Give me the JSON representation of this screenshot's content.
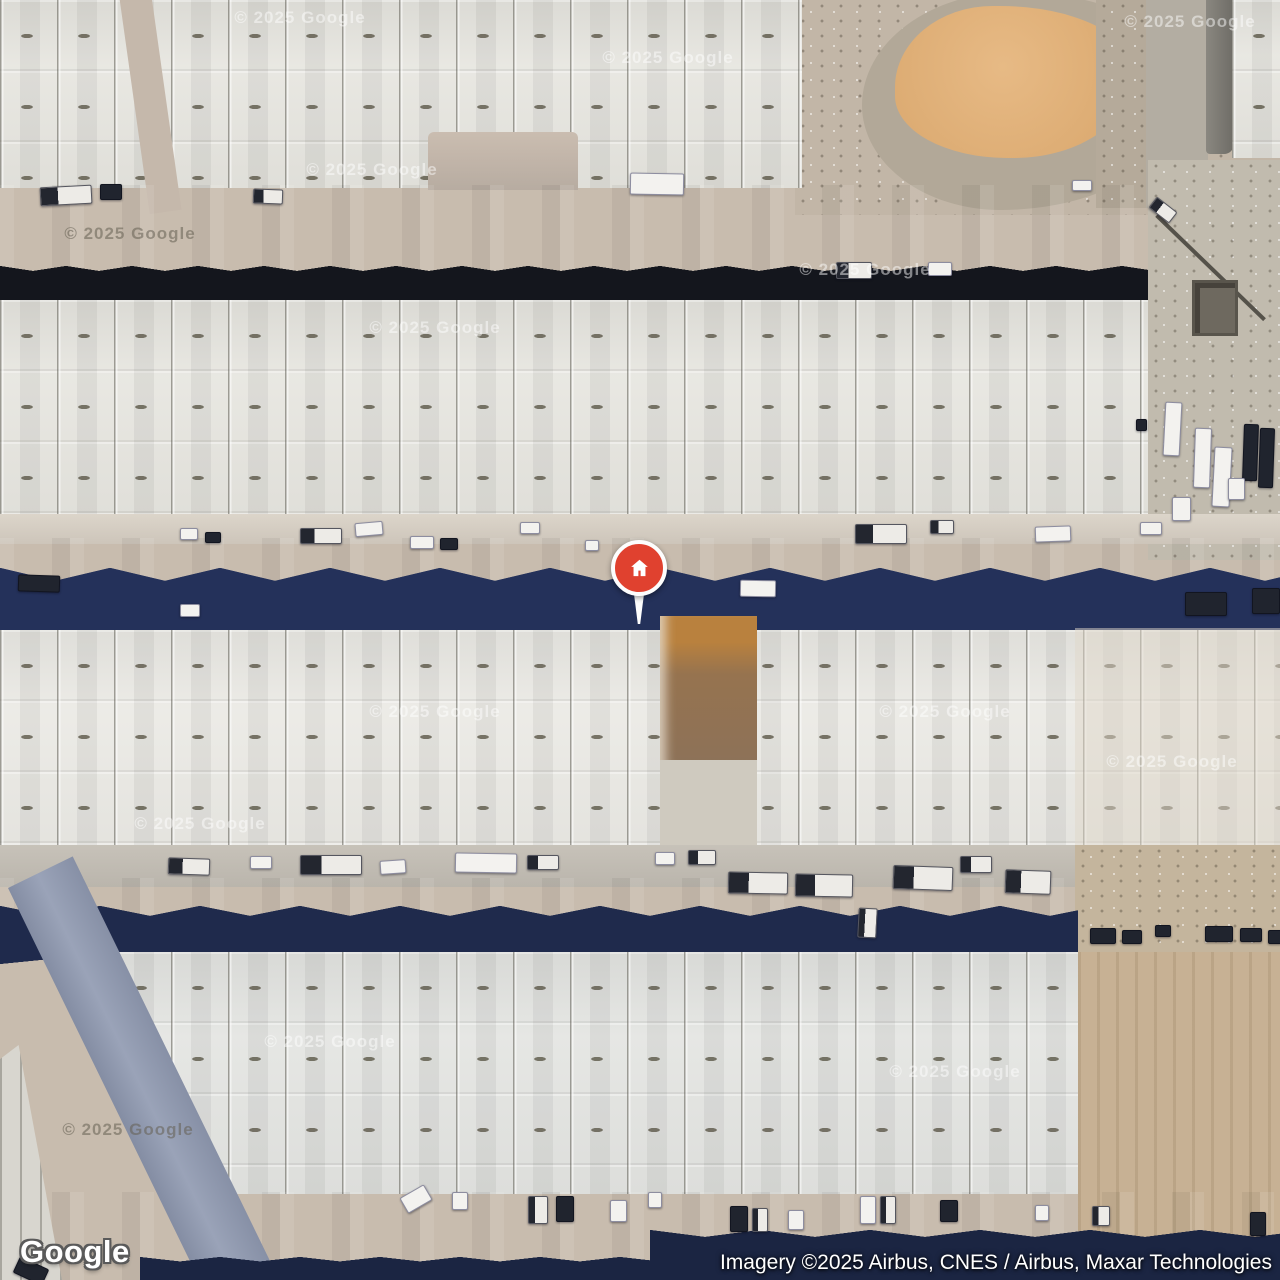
{
  "map": {
    "logo": "Google",
    "attribution": "Imagery ©2025 Airbus, CNES / Airbus, Maxar Technologies",
    "watermark_text": "© 2025 Google",
    "marker": {
      "x": 639,
      "y": 624,
      "icon": "home-icon",
      "color": "#E0412F"
    },
    "colors": {
      "marker_red": "#E0412F",
      "shadow_navy": "#24315A",
      "shadow_black": "#14161D",
      "roof_light": "#E7E6E0",
      "road_blue": "#99A3B8",
      "road_tan": "#C6B9AD",
      "sand": "#DCAB72"
    },
    "watermarks": [
      [
        300,
        18,
        "light"
      ],
      [
        668,
        58,
        "light"
      ],
      [
        1190,
        22,
        "light"
      ],
      [
        372,
        170,
        "light"
      ],
      [
        130,
        234,
        "dark"
      ],
      [
        435,
        328,
        "light"
      ],
      [
        865,
        270,
        "light"
      ],
      [
        435,
        712,
        "light"
      ],
      [
        945,
        712,
        "light"
      ],
      [
        1172,
        762,
        "light"
      ],
      [
        200,
        824,
        "light"
      ],
      [
        330,
        1042,
        "light"
      ],
      [
        955,
        1072,
        "light"
      ],
      [
        128,
        1130,
        "dark"
      ]
    ],
    "vehicles": [
      [
        40,
        186,
        50,
        17,
        -3,
        "m"
      ],
      [
        100,
        184,
        20,
        14,
        0,
        "d"
      ],
      [
        253,
        189,
        28,
        13,
        2,
        "m"
      ],
      [
        630,
        173,
        52,
        20,
        1,
        "w"
      ],
      [
        836,
        262,
        34,
        15,
        0,
        "m"
      ],
      [
        928,
        262,
        22,
        12,
        0,
        "w"
      ],
      [
        1072,
        180,
        18,
        9,
        0,
        "w"
      ],
      [
        1150,
        203,
        24,
        12,
        38,
        "m"
      ],
      [
        1164,
        402,
        15,
        52,
        3,
        "w"
      ],
      [
        1194,
        428,
        15,
        58,
        2,
        "w"
      ],
      [
        1213,
        447,
        16,
        58,
        3,
        "w"
      ],
      [
        1243,
        424,
        13,
        55,
        2,
        "d"
      ],
      [
        1259,
        428,
        13,
        58,
        2,
        "d"
      ],
      [
        1172,
        497,
        17,
        22,
        0,
        "w"
      ],
      [
        1228,
        478,
        15,
        20,
        0,
        "w"
      ],
      [
        1136,
        419,
        9,
        10,
        0,
        "d"
      ],
      [
        180,
        528,
        16,
        10,
        0,
        "w"
      ],
      [
        205,
        532,
        14,
        9,
        0,
        "d"
      ],
      [
        300,
        528,
        40,
        14,
        0,
        "m"
      ],
      [
        355,
        522,
        26,
        12,
        -5,
        "w"
      ],
      [
        410,
        536,
        22,
        11,
        0,
        "w"
      ],
      [
        440,
        538,
        16,
        10,
        0,
        "d"
      ],
      [
        520,
        522,
        18,
        10,
        0,
        "w"
      ],
      [
        585,
        540,
        12,
        9,
        0,
        "w"
      ],
      [
        18,
        575,
        40,
        15,
        2,
        "d"
      ],
      [
        180,
        604,
        18,
        11,
        0,
        "w"
      ],
      [
        740,
        580,
        34,
        15,
        1,
        "w"
      ],
      [
        855,
        524,
        50,
        18,
        0,
        "m"
      ],
      [
        930,
        520,
        22,
        12,
        0,
        "m"
      ],
      [
        1035,
        526,
        34,
        14,
        -2,
        "w"
      ],
      [
        1140,
        522,
        20,
        11,
        0,
        "w"
      ],
      [
        1185,
        592,
        40,
        22,
        0,
        "d"
      ],
      [
        1252,
        588,
        26,
        24,
        0,
        "d"
      ],
      [
        168,
        858,
        40,
        15,
        2,
        "m"
      ],
      [
        250,
        856,
        20,
        11,
        0,
        "w"
      ],
      [
        300,
        855,
        60,
        18,
        0,
        "m"
      ],
      [
        380,
        860,
        24,
        12,
        -4,
        "w"
      ],
      [
        455,
        853,
        60,
        18,
        1,
        "w"
      ],
      [
        527,
        855,
        30,
        13,
        0,
        "m"
      ],
      [
        655,
        852,
        18,
        11,
        0,
        "w"
      ],
      [
        688,
        850,
        26,
        13,
        0,
        "m"
      ],
      [
        728,
        872,
        58,
        20,
        1,
        "m"
      ],
      [
        795,
        874,
        56,
        21,
        1,
        "m"
      ],
      [
        893,
        866,
        58,
        22,
        2,
        "m"
      ],
      [
        960,
        856,
        30,
        15,
        0,
        "m"
      ],
      [
        1005,
        870,
        44,
        22,
        2,
        "m"
      ],
      [
        858,
        908,
        17,
        28,
        3,
        "m"
      ],
      [
        1090,
        928,
        24,
        14,
        0,
        "d"
      ],
      [
        1122,
        930,
        18,
        12,
        0,
        "d"
      ],
      [
        1155,
        925,
        14,
        10,
        0,
        "d"
      ],
      [
        1205,
        926,
        26,
        14,
        0,
        "d"
      ],
      [
        1240,
        928,
        20,
        12,
        0,
        "d"
      ],
      [
        1268,
        930,
        12,
        12,
        0,
        "d"
      ],
      [
        402,
        1190,
        26,
        16,
        -30,
        "w"
      ],
      [
        452,
        1192,
        14,
        16,
        0,
        "w"
      ],
      [
        528,
        1196,
        18,
        26,
        0,
        "m"
      ],
      [
        556,
        1196,
        16,
        24,
        0,
        "d"
      ],
      [
        610,
        1200,
        15,
        20,
        0,
        "w"
      ],
      [
        648,
        1192,
        12,
        14,
        0,
        "w"
      ],
      [
        730,
        1206,
        16,
        24,
        0,
        "d"
      ],
      [
        752,
        1208,
        14,
        22,
        0,
        "m"
      ],
      [
        788,
        1210,
        14,
        18,
        0,
        "w"
      ],
      [
        860,
        1196,
        14,
        26,
        0,
        "w"
      ],
      [
        880,
        1196,
        14,
        26,
        0,
        "m"
      ],
      [
        940,
        1200,
        16,
        20,
        0,
        "d"
      ],
      [
        1035,
        1205,
        12,
        14,
        0,
        "w"
      ],
      [
        1092,
        1206,
        16,
        18,
        0,
        "m"
      ],
      [
        1250,
        1212,
        14,
        22,
        0,
        "d"
      ],
      [
        15,
        1262,
        30,
        16,
        25,
        "d"
      ]
    ]
  }
}
